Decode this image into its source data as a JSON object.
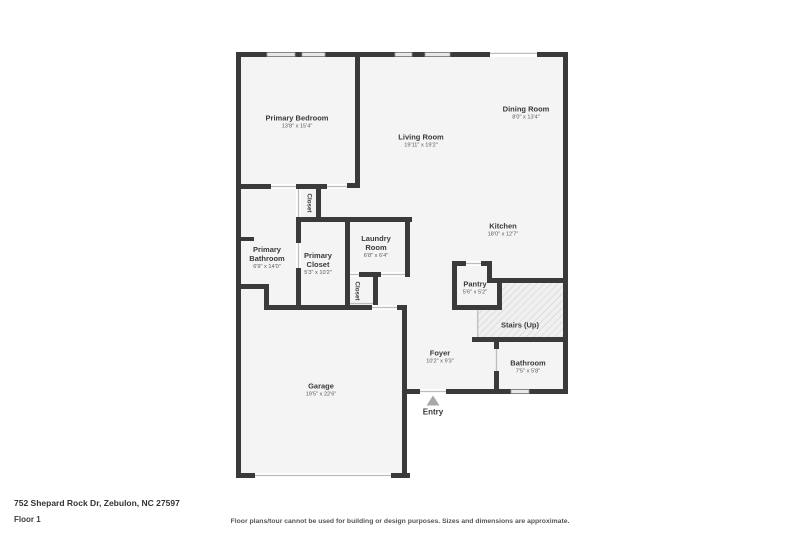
{
  "page": {
    "address": "752 Shepard Rock Dr, Zebulon, NC 27597",
    "floor_label": "Floor 1",
    "disclaimer": "Floor plans/tour cannot be used for building or design purposes. Sizes and dimensions are approximate."
  },
  "colors": {
    "wall": "#3a3a3a",
    "floor": "#f4f4f4",
    "window": "#e8e8e8",
    "window_frame": "#9a9a9a",
    "opening_line": "#bdbdbd",
    "stairs_bg": "#f0f0f0",
    "stairs_hatch": "#cccccc",
    "entry_marker": "#a8a8a8",
    "label": "#3a3a3a",
    "dims": "#5a5a5a"
  },
  "rooms": {
    "primary_bedroom": {
      "name": "Primary Bedroom",
      "dims": "13'8\" x 15'4\""
    },
    "living_room": {
      "name": "Living Room",
      "dims": "19'11\" x 19'2\""
    },
    "dining_room": {
      "name": "Dining Room",
      "dims": "8'0\" x 13'4\""
    },
    "kitchen": {
      "name": "Kitchen",
      "dims": "18'0\" x 12'7\""
    },
    "primary_bathroom": {
      "name": "Primary Bathroom",
      "dims": "6'9\" x 14'0\""
    },
    "primary_closet": {
      "name": "Primary Closet",
      "dims": "5'3\" x 10'2\""
    },
    "laundry_room": {
      "name": "Laundry Room",
      "dims": "6'8\" x 6'4\""
    },
    "pantry": {
      "name": "Pantry",
      "dims": "5'6\" x 5'2\""
    },
    "stairs": {
      "name": "Stairs (Up)"
    },
    "foyer": {
      "name": "Foyer",
      "dims": "10'2\" x 9'3\""
    },
    "bathroom": {
      "name": "Bathroom",
      "dims": "7'5\" x 5'8\""
    },
    "garage": {
      "name": "Garage",
      "dims": "19'5\" x 22'6\""
    },
    "closet_hall": {
      "name": "Closet"
    },
    "closet_laundry": {
      "name": "Closet"
    }
  },
  "markers": {
    "entry_label": "Entry"
  }
}
